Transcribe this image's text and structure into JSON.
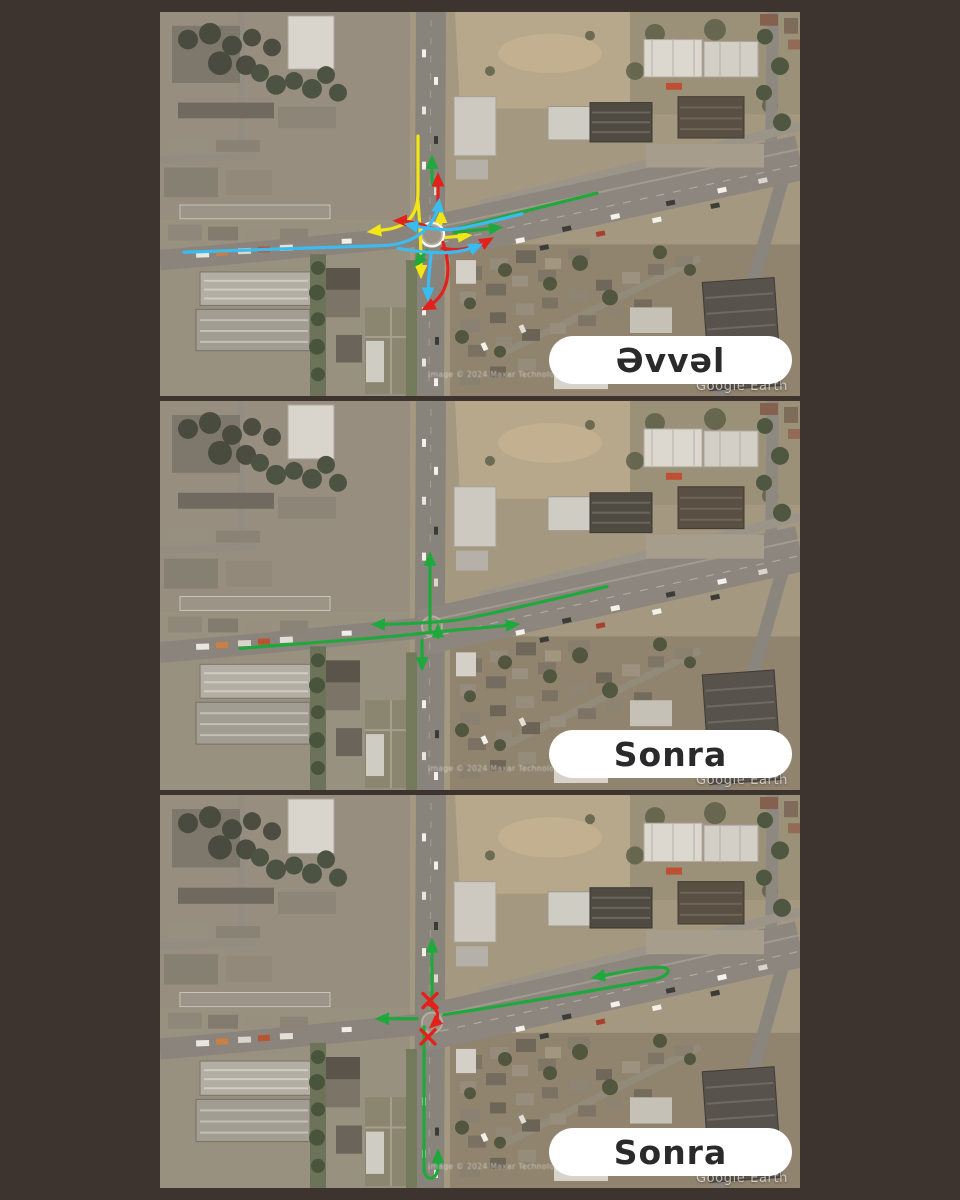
{
  "page": {
    "background_color": "#3d3430"
  },
  "annotation_colors": {
    "green": "#1fa83c",
    "yellow": "#f2e715",
    "red": "#e2211a",
    "cyan": "#3bbcf0",
    "white": "#f8f8f0"
  },
  "panels": [
    {
      "label": "Əvvəl",
      "watermark": "Google Earth",
      "attribution": "Image © 2024 Maxar Technologies",
      "arrows": [
        {
          "c": "white",
          "d": "M284,226 a12,12 0 1,1 -24,0 a12,12 0 1,1 24,0",
          "m": false,
          "w": 2.4
        },
        {
          "c": "green",
          "d": "M437,184 L300,219",
          "m": false
        },
        {
          "c": "yellow",
          "d": "M258,126 L258,183 C258,208 246,218 226,221 L211,223",
          "m": true
        },
        {
          "c": "yellow",
          "d": "M258,192 C261,228 261,248 261,267",
          "m": true
        },
        {
          "c": "yellow",
          "d": "M286,229 L308,227",
          "m": true
        },
        {
          "c": "yellow",
          "d": "M281,215 L281,204",
          "m": true
        },
        {
          "c": "green",
          "d": "M272,174 L272,149",
          "m": true
        },
        {
          "c": "green",
          "d": "M294,224 L339,219",
          "m": true
        },
        {
          "c": "green",
          "d": "M267,242 L256,256",
          "m": true
        },
        {
          "c": "red",
          "d": "M283,234 C292,262 290,288 265,301",
          "m": true
        },
        {
          "c": "red",
          "d": "M270,219 C258,214 248,212 237,212",
          "m": true
        },
        {
          "c": "red",
          "d": "M282,240 C302,244 318,238 330,231",
          "m": true
        },
        {
          "c": "red",
          "d": "M278,193 L278,167",
          "m": true
        },
        {
          "c": "cyan",
          "d": "M24,244 L228,237 C258,234 276,216 279,193",
          "m": true
        },
        {
          "c": "cyan",
          "d": "M238,240 C282,248 304,244 319,237",
          "m": true
        },
        {
          "c": "cyan",
          "d": "M362,205 C330,213 300,221 288,221 C272,221 258,218 248,216",
          "m": true
        },
        {
          "c": "cyan",
          "d": "M271,247 C269,266 268,278 268,290",
          "m": true
        }
      ]
    },
    {
      "label": "Sonra",
      "watermark": "Google Earth",
      "attribution": "Image © 2024 Maxar Technologies",
      "arrows": [
        {
          "c": "green",
          "d": "M270,230 L270,155",
          "m": true
        },
        {
          "c": "green",
          "d": "M447,186 C380,202 320,216 300,219 C282,222 235,224 215,224",
          "m": true
        },
        {
          "c": "green",
          "d": "M80,248 C170,241 225,237 252,234 C286,230 330,227 356,224",
          "m": true
        },
        {
          "c": "green",
          "d": "M262,240 L262,267",
          "m": true
        },
        {
          "c": "green",
          "d": "M278,237 L278,227",
          "m": true
        }
      ]
    },
    {
      "label": "Sonra",
      "watermark": "Google Earth",
      "attribution": "Image © 2024 Maxar Technologies",
      "arrows": [
        {
          "c": "green",
          "d": "M272,212 L272,146",
          "m": true
        },
        {
          "c": "green",
          "d": "M257,222 L219,222",
          "m": true
        },
        {
          "c": "green",
          "d": "M284,218 C350,208 440,193 490,184 C508,181 514,172 502,171 C488,170 460,176 435,181",
          "m": true
        },
        {
          "c": "green",
          "d": "M264,230 L264,370 C264,384 278,384 278,368 L278,355",
          "m": true
        },
        {
          "c": "red",
          "d": "M263,197 L277,211 M277,197 L263,211",
          "m": false,
          "w": 3.4
        },
        {
          "c": "red",
          "d": "M261,233 L275,247 M275,233 L261,247",
          "m": false,
          "w": 3.4
        },
        {
          "c": "red",
          "d": "M267,207 C279,212 281,221 272,229",
          "m": true,
          "w": 3
        }
      ]
    }
  ]
}
